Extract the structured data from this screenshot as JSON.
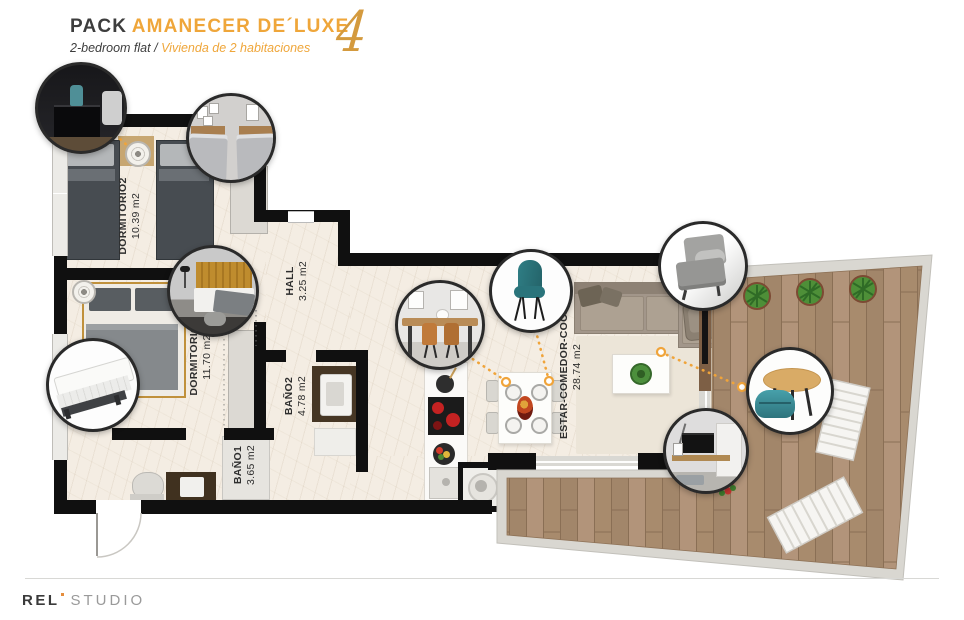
{
  "header": {
    "title_prefix": "PACK",
    "title_main": "AMANECER DE´LUXE",
    "subtitle_en": "2-bedroom flat",
    "subtitle_divider": "/",
    "subtitle_es": "Vivienda de 2 habitaciones",
    "pack_number": "4"
  },
  "rooms": [
    {
      "label": "DORMITORIO2",
      "area": "10.39 m2"
    },
    {
      "label": "DORMITORIO1",
      "area": "11.70 m2"
    },
    {
      "label": "HALL",
      "area": "3.25 m2"
    },
    {
      "label": "BAÑO2",
      "area": "4.78 m2"
    },
    {
      "label": "BAÑO1",
      "area": "3.65 m2"
    },
    {
      "label": "ESTAR-COMEDOR-COCINA",
      "area": "28.74 m2"
    }
  ],
  "callouts": [
    {
      "name": "nightstand-photo"
    },
    {
      "name": "twin-beds-photo"
    },
    {
      "name": "bed-headboard-photo"
    },
    {
      "name": "mattress-photo"
    },
    {
      "name": "dining-table-photo"
    },
    {
      "name": "teal-chair-photo"
    },
    {
      "name": "armchair-photo"
    },
    {
      "name": "coffee-table-pouf-photo"
    },
    {
      "name": "tv-unit-photo"
    }
  ],
  "footer": {
    "logo_text": "REL",
    "logo_suffix": "STUDIO"
  },
  "colors": {
    "accent_orange": "#EFA63A",
    "wall_black": "#101010",
    "floor_cream": "#F4EDE3",
    "deck_wood": "#AC8F71",
    "teal": "#3F96A0"
  }
}
